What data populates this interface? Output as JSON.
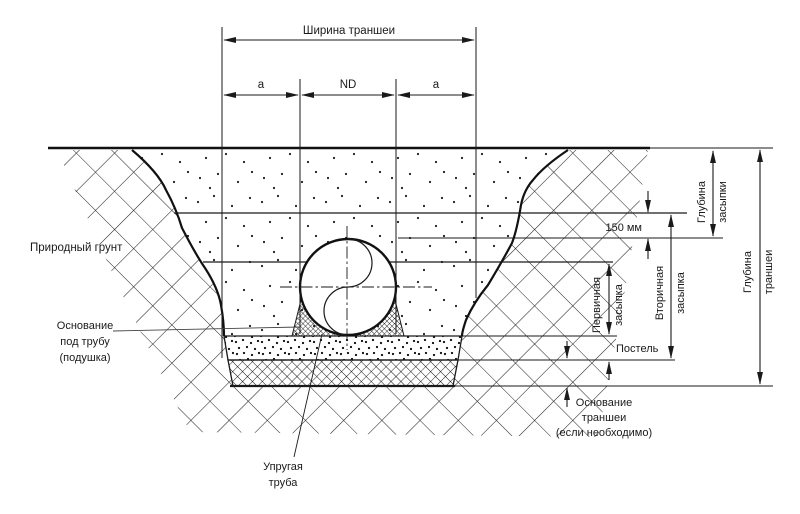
{
  "diagram": {
    "width_label": "Ширина траншеи",
    "a_left": "a",
    "nd": "ND",
    "a_right": "a",
    "natural_soil": "Природный грунт",
    "pipe_base_line1": "Основание",
    "pipe_base_line2": "под трубу",
    "pipe_base_line3": "(подушка)",
    "flexible_pipe_line1": "Упругая",
    "flexible_pipe_line2": "труба",
    "dim_150mm": "150 мм",
    "bedding": "Постель",
    "primary_line1": "Первичная",
    "primary_line2": "засыпка",
    "secondary_line1": "Вторичная",
    "secondary_line2": "засыпка",
    "cover_depth_line1": "Глубина",
    "cover_depth_line2": "засыпки",
    "trench_depth_line1": "Глубина",
    "trench_depth_line2": "траншеи",
    "trench_base_line1": "Основание",
    "trench_base_line2": "траншеи",
    "trench_base_line3": "(если необходимо)"
  },
  "colors": {
    "ink": "#1a1a1a",
    "background": "#ffffff"
  }
}
